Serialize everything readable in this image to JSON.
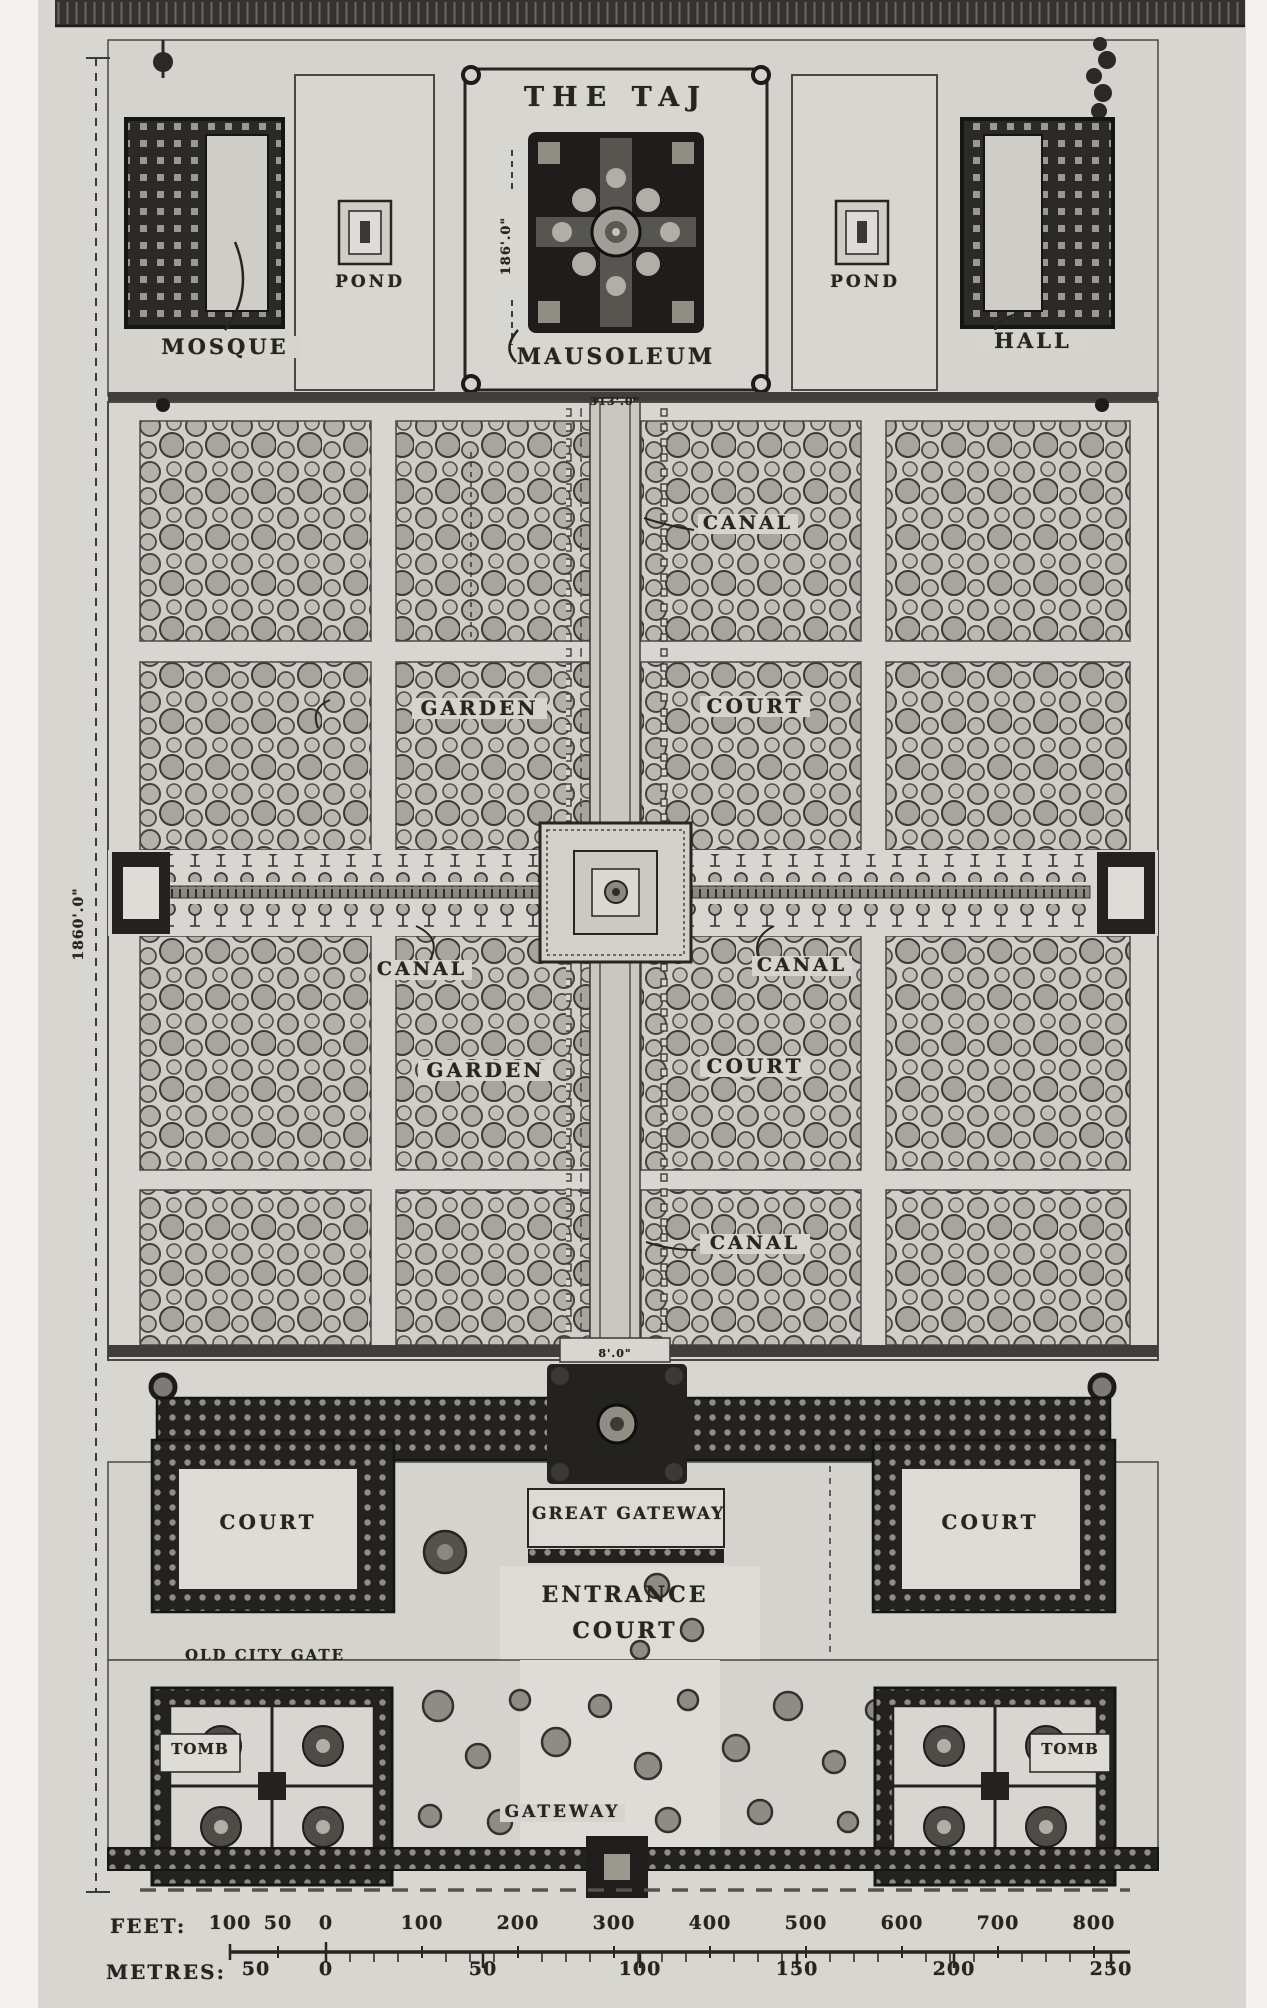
{
  "title": "THE TAJ",
  "colors": {
    "paper": "#d8d6d1",
    "ink": "#26251f",
    "dark_structure": "#23221f",
    "tree_gray": "#8e8c84"
  },
  "terrace": {
    "mosque_label": "MOSQUE",
    "hall_label": "HALL",
    "pond_left_label": "POND",
    "pond_right_label": "POND",
    "mausoleum_label": "MAUSOLEUM",
    "mausoleum_dim": "186'.0\"",
    "platform_dim": "313'.0\""
  },
  "garden": {
    "canal_upper": "CANAL",
    "canal_mid_left": "CANAL",
    "canal_mid_right": "CANAL",
    "canal_lower": "CANAL",
    "garden_upper": "GARDEN",
    "garden_lower": "GARDEN",
    "court_upper": "COURT",
    "court_lower": "COURT",
    "enclosure_dim": "1860'.0\"",
    "path_dim": "8'.0\""
  },
  "entrance": {
    "great_gateway_label": "GREAT GATEWAY",
    "entrance_court_line1": "ENTRANCE",
    "entrance_court_line2": "COURT",
    "court_left_label": "COURT",
    "court_right_label": "COURT"
  },
  "outer_court": {
    "caption": "OLD CITY GATE",
    "tomb_left_label": "TOMB",
    "tomb_right_label": "TOMB",
    "gateway_label": "GATEWAY"
  },
  "scale": {
    "feet_label": "FEET:",
    "feet_ticks": [
      "100",
      "50",
      "0",
      "100",
      "200",
      "300",
      "400",
      "500",
      "600",
      "700",
      "800"
    ],
    "metres_label": "METRES:",
    "metres_ticks": [
      "50",
      "0",
      "50",
      "100",
      "150",
      "200",
      "250"
    ]
  }
}
